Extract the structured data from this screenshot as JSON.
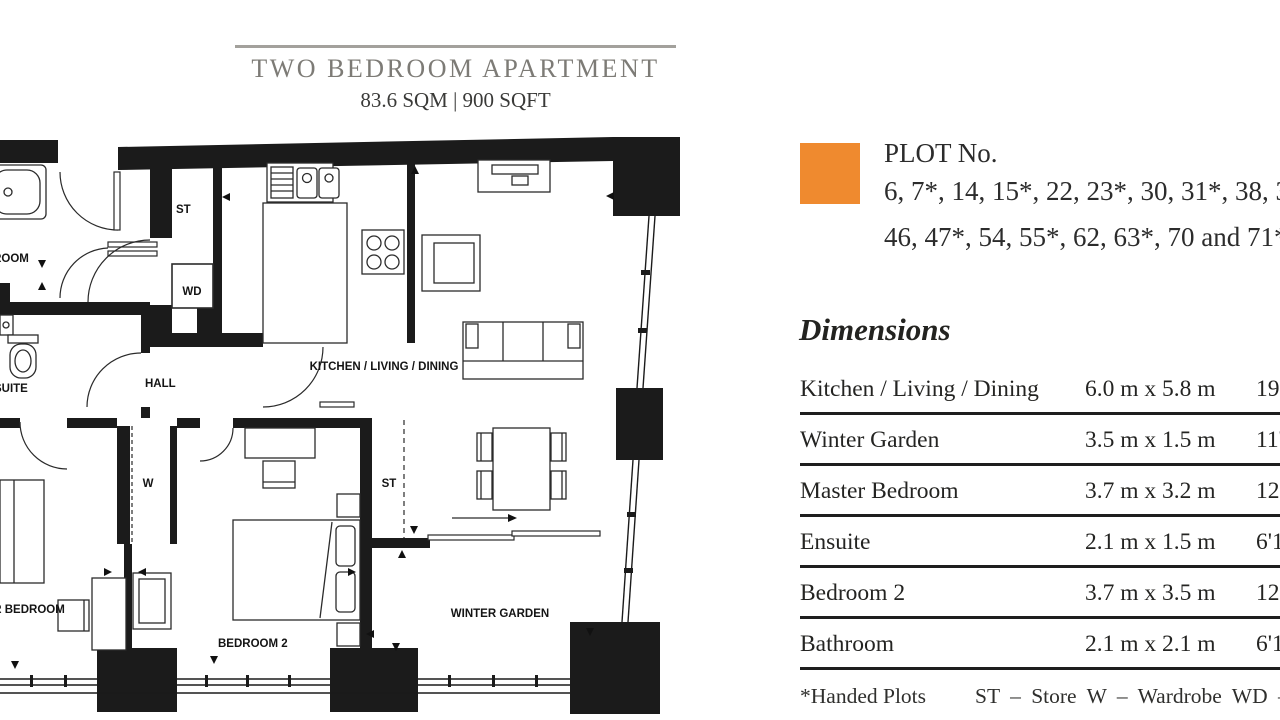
{
  "header": {
    "title": "TWO BEDROOM APARTMENT",
    "area": "83.6 SQM | 900 SQFT"
  },
  "plot": {
    "label": "PLOT No.",
    "numbers_line1": "6, 7*, 14, 15*, 22, 23*, 30, 31*, 38, 39*",
    "numbers_line2": "46, 47*, 54, 55*, 62, 63*, 70 and 71*",
    "swatch_color": "#EF8A2F"
  },
  "dimensions": {
    "heading": "Dimensions",
    "rows": [
      {
        "room": "Kitchen / Living / Dining",
        "metric": "6.0 m x 5.8 m",
        "imperial": "19'8\" x 19'0\""
      },
      {
        "room": "Winter Garden",
        "metric": "3.5 m x 1.5 m",
        "imperial": "11'6\" x 4'11\""
      },
      {
        "room": "Master Bedroom",
        "metric": "3.7 m x 3.2 m",
        "imperial": "12'2\" x 10'6\""
      },
      {
        "room": "Ensuite",
        "metric": "2.1 m x 1.5 m",
        "imperial": "6'11\" x 4'11\""
      },
      {
        "room": "Bedroom 2",
        "metric": "3.7 m x 3.5 m",
        "imperial": "12'2\" x 11'6\""
      },
      {
        "room": "Bathroom",
        "metric": "2.1 m x 2.1 m",
        "imperial": "6'11\" x 6'11\""
      }
    ]
  },
  "footnote": {
    "handed": "*Handed Plots",
    "legend": "ST – Store W – Wardrobe WD – Washer Dryer"
  },
  "floorplan": {
    "labels": {
      "bathroom": "BATHROOM",
      "store_1": "ST",
      "washer_dryer": "WD",
      "hall": "HALL",
      "kitchen_living_dining": "KITCHEN / LIVING / DINING",
      "ensuite": "ENSUITE",
      "wardrobe": "W",
      "master_bedroom": "MASTER BEDROOM",
      "store_2": "ST",
      "bedroom_2": "BEDROOM 2",
      "winter_garden": "WINTER GARDEN"
    }
  }
}
